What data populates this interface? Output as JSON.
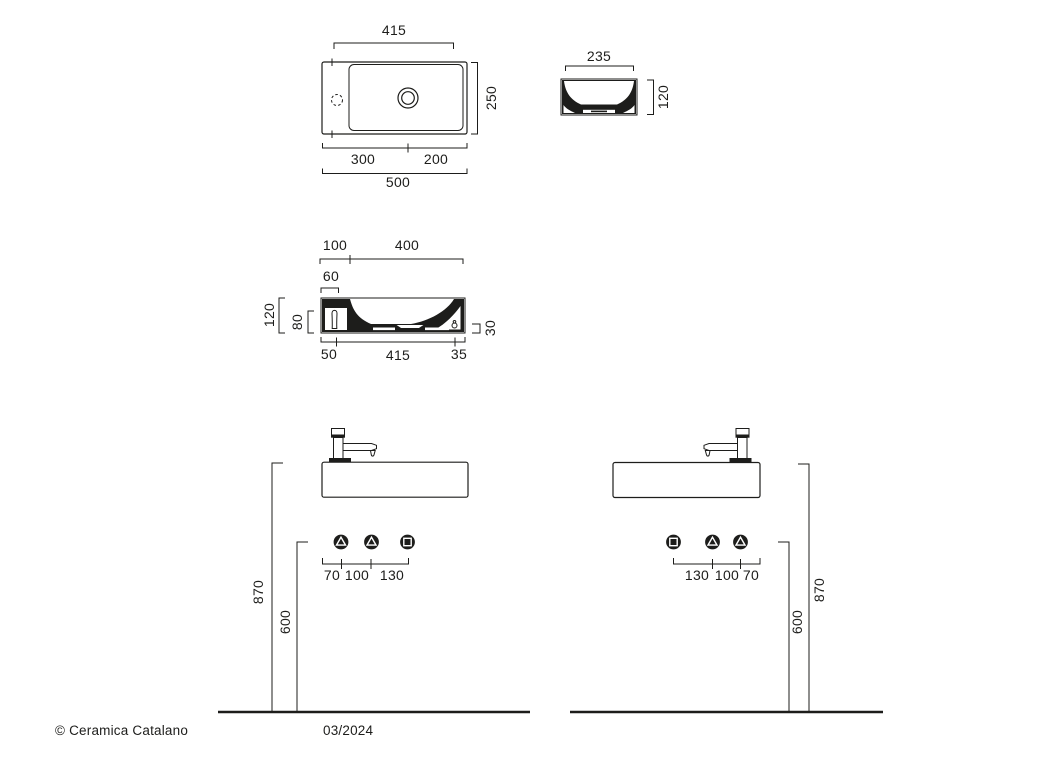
{
  "footer": {
    "copyright": "© Ceramica Catalano",
    "date": "03/2024"
  },
  "drawing": {
    "line_color": "#1d1d1b",
    "background": "#ffffff"
  },
  "views": {
    "plan": {
      "dims": {
        "top": "415",
        "right": "250",
        "bottom_left": "300",
        "bottom_right": "200",
        "bottom_total": "500"
      }
    },
    "side": {
      "dims": {
        "top": "235",
        "right": "120"
      }
    },
    "section": {
      "dims": {
        "top_left": "100",
        "top_right": "400",
        "top_inset": "60",
        "left_outer": "120",
        "left_inner": "80",
        "bottom_left": "50",
        "bottom_center": "415",
        "bottom_right": "35",
        "right": "30"
      }
    },
    "front_left": {
      "dims": {
        "height": "870",
        "supply_height": "600",
        "offsets": [
          "70",
          "100",
          "130"
        ]
      }
    },
    "front_right": {
      "dims": {
        "offsets": [
          "130",
          "100",
          "70"
        ],
        "supply_height": "600",
        "height": "870"
      }
    }
  }
}
